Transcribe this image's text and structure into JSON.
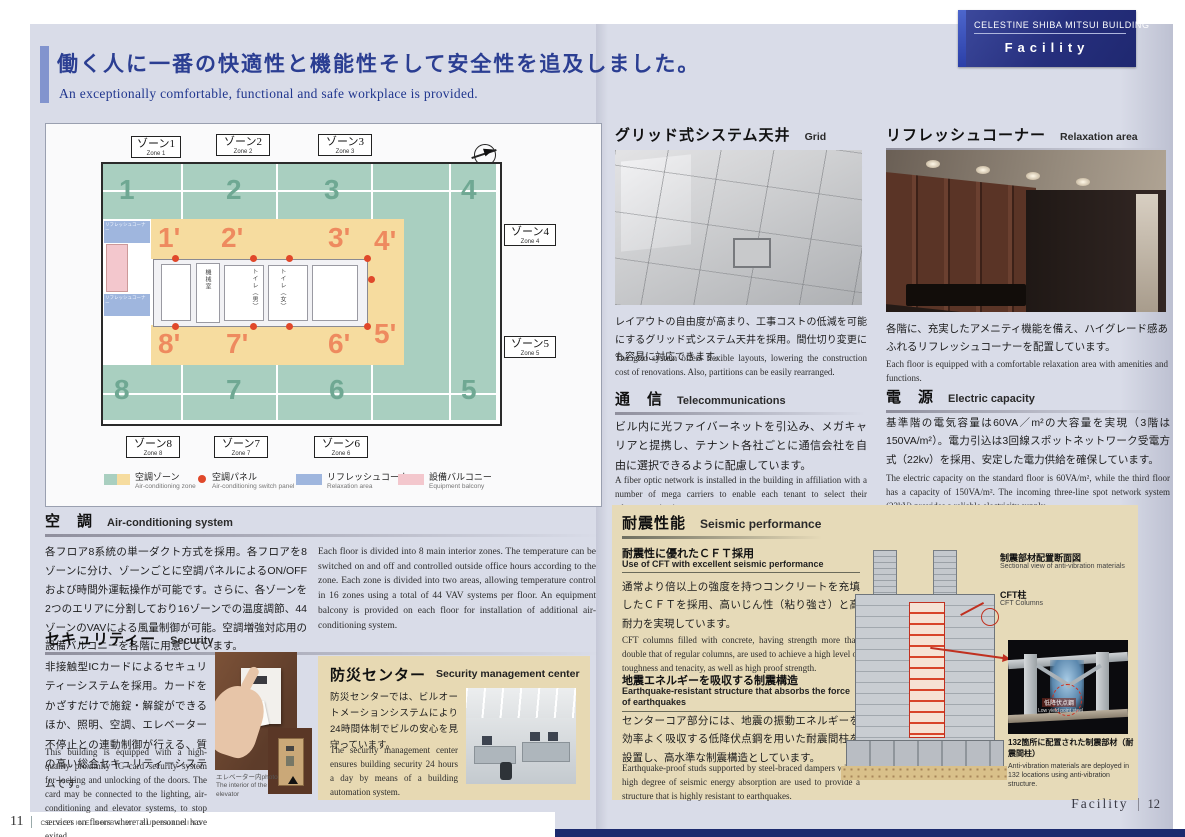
{
  "header": {
    "building": "CELESTINE SHIBA MITSUI BUILDING",
    "section": "Facility"
  },
  "title": {
    "jp": "働く人に一番の快適性と機能性そして安全性を追及しました。",
    "en": "An exceptionally comfortable, functional and safe workplace  is provided."
  },
  "floor_plan": {
    "top_labels": [
      {
        "jp": "ゾーン1",
        "en": "Zone 1"
      },
      {
        "jp": "ゾーン2",
        "en": "Zone 2"
      },
      {
        "jp": "ゾーン3",
        "en": "Zone 3"
      }
    ],
    "right_labels": [
      {
        "jp": "ゾーン4",
        "en": "Zone 4"
      },
      {
        "jp": "ゾーン5",
        "en": "Zone 5"
      }
    ],
    "bottom_labels": [
      {
        "jp": "ゾーン8",
        "en": "Zone 8"
      },
      {
        "jp": "ゾーン7",
        "en": "Zone 7"
      },
      {
        "jp": "ゾーン6",
        "en": "Zone 6"
      }
    ],
    "green_top": [
      "1",
      "2",
      "3",
      "4"
    ],
    "orange_top": [
      "1'",
      "2'",
      "3'",
      "4'"
    ],
    "orange_bottom": [
      "8'",
      "7'",
      "6'",
      "5'"
    ],
    "green_bottom": [
      "8",
      "7",
      "6",
      "5"
    ],
    "core_labels": {
      "machine_room": "機械室",
      "toilet_m": "トイレ（男）",
      "toilet_f": "トイレ（女）"
    },
    "refresh_label_1": "リフレッシュコーナー",
    "refresh_label_2": "リフレッシュコーナー",
    "legend": [
      {
        "jp": "空調ゾーン",
        "en": "Air-conditioning zone"
      },
      {
        "jp": "空調パネル",
        "en": "Air-conditioning switch panel"
      },
      {
        "jp": "リフレッシュコーナー",
        "en": "Relaxation area"
      },
      {
        "jp": "設備バルコニー",
        "en": "Equipment balcony"
      }
    ]
  },
  "sections": {
    "air": {
      "h_jp": "空　調",
      "h_en": "Air-conditioning system",
      "jp": "各フロア8系統の単一ダクト方式を採用。各フロアを8ゾーンに分け、ゾーンごとに空調パネルによるON/OFFおよび時間外運転操作が可能です。さらに、各ゾーンを2つのエリアに分割しており16ゾーンでの温度調節、44ゾーンのVAVによる風量制御が可能。空調増強対応用の設備バルコニーを各階に用意しています。",
      "en": "Each floor is divided into 8 main interior zones. The temperature can be switched on and off and controlled outside office hours according to the zone. Each zone is divided into two areas, allowing temperature control in 16 zones using a total of 44 VAV systems per floor. An equipment balcony is provided on each floor for installation of additional air-conditioning system."
    },
    "security": {
      "h_jp": "セキュリティー",
      "h_en": "Security",
      "jp": "非接触型ICカードによるセキュリティーシステムを採用。カードをかざすだけで施錠・解錠ができるほか、照明、空調、エレベーター不停止との連動制御が行える、質の高い総合セキュリティーシステムです。",
      "en": "This building is equipped with a high-quality proximity IC card security system for locking and unlocking of the doors. The card may be connected to the lighting, air-conditioning and elevator systems, to stop services on floors where all personnel have exited.",
      "caption_jp": "エレベーター内photo",
      "caption_en": "The interior of the elevator"
    },
    "disaster": {
      "h_jp": "防災センター",
      "h_en": "Security management center",
      "jp": "防災センターでは、ビルオートメーションシステムにより24時間体制でビルの安心を見守っています。",
      "en": "The security management center ensures building security 24 hours a day by means of a building automation system."
    },
    "ceiling": {
      "h_jp": "グリッド式システム天井",
      "h_en": "Grid system ceiling",
      "jp": "レイアウトの自由度が高まり、工事コストの低減を可能にするグリッド式システム天井を採用。間仕切り変更にも容易に対応できます。",
      "en": "The grid system offers flexible layouts, lowering the construction cost of renovations. Also, partitions can be easily rearranged."
    },
    "telecom": {
      "h_jp": "通　信",
      "h_en": "Telecommunications",
      "jp": "ビル内に光ファイバーネットを引込み、メガキャリアと提携し、テナント各社ごとに通信会社を自由に選択できるように配慮しています。",
      "en": "A fiber optic network is installed in the building in affiliation with a number of mega carriers to enable each tenant to select their telecommunication company."
    },
    "relax": {
      "h_jp": "リフレッシュコーナー",
      "h_en": "Relaxation area",
      "jp": "各階に、充実したアメニティ機能を備え、ハイグレード感あふれるリフレッシュコーナーを配置しています。",
      "en": "Each floor is equipped with a comfortable relaxation area with amenities and functions."
    },
    "electric": {
      "h_jp": "電　源",
      "h_en": "Electric capacity",
      "jp": "基準階の電気容量は60VA／m²の大容量を実現（3階は150VA/m²）。電力引込は3回線スポットネットワーク受電方式（22kv）を採用、安定した電力供給を確保しています。",
      "en": "The electric capacity on the standard floor is 60VA/m², while the third floor has a capacity of 150VA/m². The incoming three-line spot network system (22kV) provides a reliable electricity supply."
    },
    "seismic": {
      "h_jp": "耐震性能",
      "h_en": "Seismic performance",
      "sub1_jp": "耐震性に優れたＣＦＴ採用",
      "sub1_en": "Use of CFT with excellent seismic performance",
      "body1_jp": "通常より倍以上の強度を持つコンクリートを充填したＣＦＴを採用、高いじん性（粘り強さ）と高耐力を実現しています。",
      "body1_en": "CFT columns filled with concrete, having strength more than double that of regular columns, are used to achieve a high level of toughness and tenacity, as well as high proof strength.",
      "sub2_jp": "地震エネルギーを吸収する制震構造",
      "sub2_en": "Earthquake-resistant structure that absorbs the force of earthquakes",
      "body2_jp": "センターコア部分には、地震の振動エネルギーを効率よく吸収する低降伏点鋼を用いた耐震間柱を設置し、高水準な制震構造としています。",
      "body2_en": "Earthquake-proof studs supported by steel-braced dampers with a high degree of seismic energy absorption are used to provide a structure that is highly resistant to earthquakes.",
      "diagram": {
        "label1_jp": "制震部材配置断面図",
        "label1_en": "Sectional view of anti-vibration materials",
        "label2_jp": "CFT柱",
        "label2_en": "CFT Columns",
        "label3_jp": "低降伏点鋼",
        "label3_en": "Low yield point steel",
        "caption_jp": "132箇所に配置された制震部材（耐震間柱）",
        "caption_en": "Anti-vibration materials are deployed in 132 locations using anti-vibration structure."
      }
    }
  },
  "footer": {
    "left_page": "11",
    "left_text": "CELESTINE SHIBA MITSUI BUILDING",
    "right_text": "Facility",
    "right_page": "12"
  },
  "colors": {
    "accent_navy": "#27348b",
    "green_zone": "#a9cfc0",
    "orange_zone": "#f6dc9f",
    "blue_zone": "#9fb6de",
    "pink_zone": "#f3c7cd",
    "tan_panel": "#e7d9b3",
    "red_dot": "#e0482a"
  }
}
